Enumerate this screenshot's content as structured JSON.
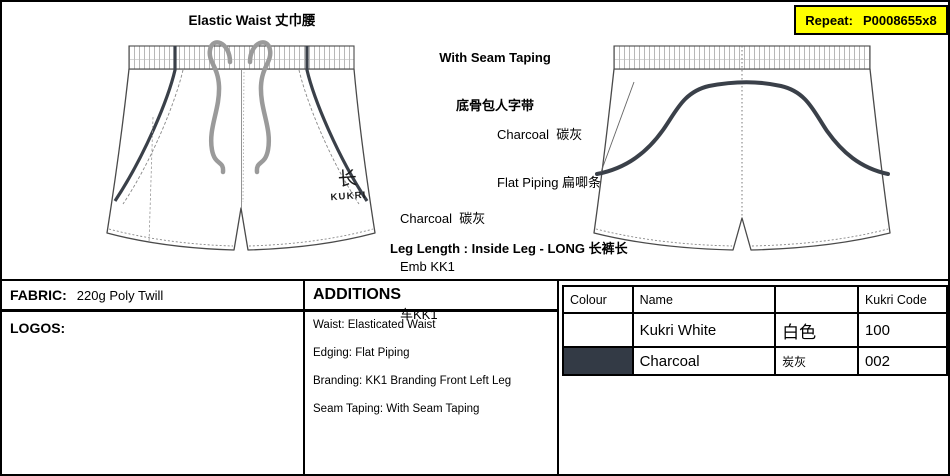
{
  "repeat_box": {
    "label": "Repeat:",
    "value": "P0008655x8",
    "bg": "#ffff00"
  },
  "annotations": {
    "elastic_waist": "Elastic Waist 丈巾腰",
    "seam_taping_line1": "With Seam Taping",
    "seam_taping_line2": "底骨包人字带",
    "piping_line1": "Charcoal  碳灰",
    "piping_line2": "Flat Piping 扁唧条",
    "emb_line1": "Charcoal  碳灰",
    "emb_line2": "Emb KK1",
    "emb_line3": "车KK1",
    "leg_length": "Leg Length : Inside Leg - LONG 长裤长"
  },
  "drawing": {
    "front_logo_glyph": "长",
    "front_logo_text": "KUKRI",
    "piping_color": "#3a4049",
    "drawcord_color": "#9a9a9a",
    "outline_color": "#4a4a4a"
  },
  "fabric": {
    "label": "FABRIC:",
    "value": "220g Poly Twill"
  },
  "logos": {
    "label": "LOGOS:"
  },
  "additions": {
    "title": "ADDITIONS",
    "items": [
      "Waist: Elasticated Waist",
      "Edging: Flat Piping",
      "Branding: KK1 Branding Front Left Leg",
      "Seam Taping: With Seam Taping"
    ]
  },
  "colour_table": {
    "headers": [
      "Colour",
      "Name",
      "",
      "Kukri Code"
    ],
    "rows": [
      {
        "swatch": "#ffffff",
        "name": "Kukri White",
        "cn": "白色",
        "code": "100"
      },
      {
        "swatch": "#333a45",
        "name": "Charcoal",
        "cn": "炭灰",
        "code": "002"
      }
    ]
  }
}
